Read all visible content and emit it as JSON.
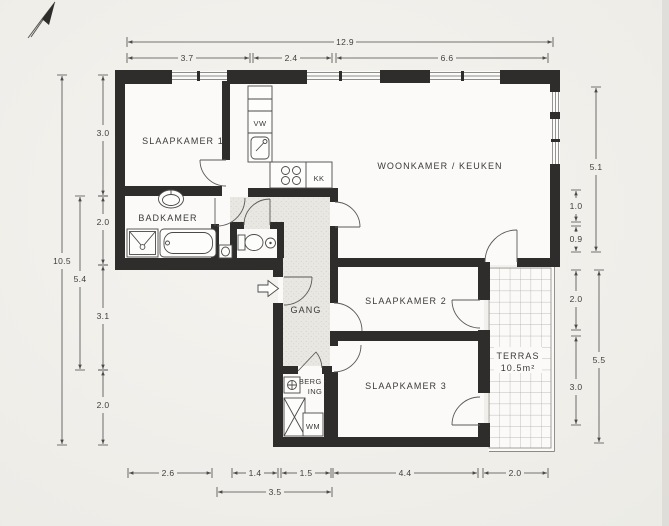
{
  "rooms": {
    "slaapkamer1": "SLAAPKAMER 1",
    "woonkamer_keuken": "WOONKAMER / KEUKEN",
    "badkamer": "BADKAMER",
    "gang": "GANG",
    "slaapkamer2": "SLAAPKAMER 2",
    "slaapkamer3": "SLAAPKAMER 3",
    "berging_line1": "BERG -",
    "berging_line2": "ING",
    "terras": "TERRAS",
    "terras_area": "10.5m²"
  },
  "labels": {
    "vw": "VW",
    "kk": "KK",
    "wm": "WM"
  },
  "dims": {
    "top": {
      "total": "12.9",
      "a": "3.7",
      "b": "2.4",
      "c": "6.6"
    },
    "left": {
      "total": "10.5",
      "inner": "5.4",
      "a": "3.0",
      "b": "2.0",
      "c": "3.1",
      "d": "2.0"
    },
    "right": {
      "a": "5.1",
      "b": "1.0",
      "c": "0.9",
      "d": "2.0",
      "e": "3.0",
      "total": "5.5"
    },
    "bottom": {
      "a": "2.6",
      "b": "1.4",
      "c": "1.5",
      "d": "4.4",
      "e": "2.0",
      "total": "3.5"
    }
  },
  "icons": {
    "north": "north-arrow",
    "entry": "entry-arrow"
  },
  "colors": {
    "wall": "#2e2d2b",
    "paper": "#f2f0ec",
    "hall_fill": "#e9e7e2",
    "line": "#4a4a4a",
    "text": "#3a3a3a"
  }
}
